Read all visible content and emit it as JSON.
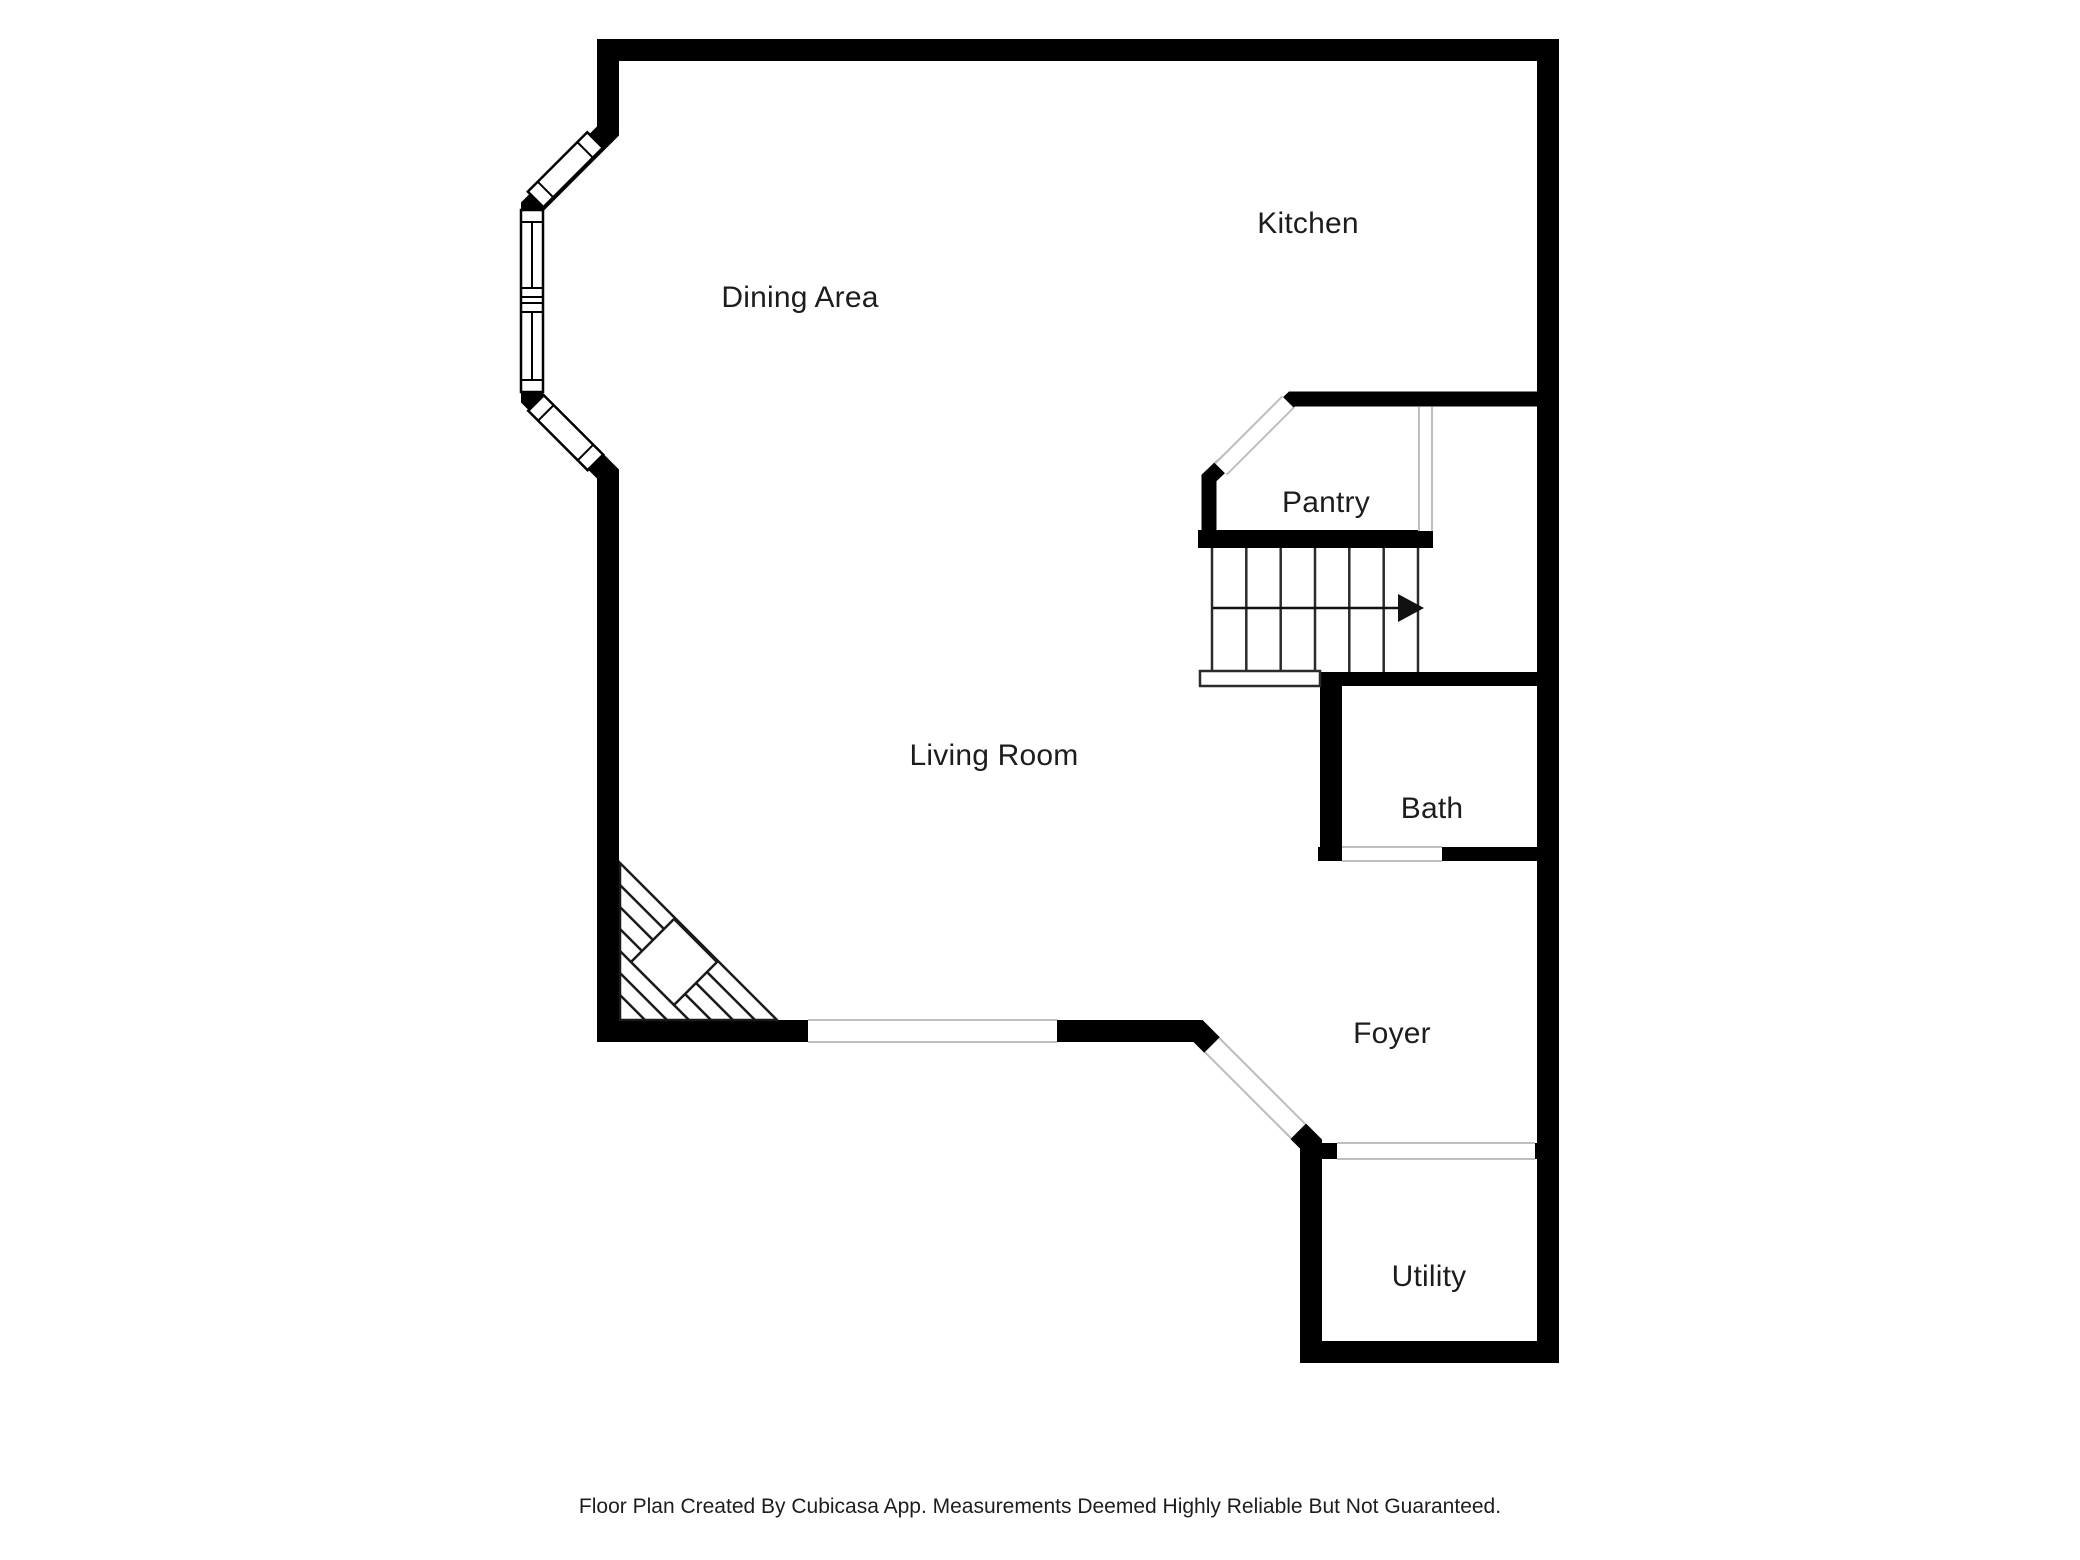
{
  "rooms": {
    "kitchen": {
      "label": "Kitchen"
    },
    "dining": {
      "label": "Dining Area"
    },
    "pantry": {
      "label": "Pantry"
    },
    "living": {
      "label": "Living Room"
    },
    "bath": {
      "label": "Bath"
    },
    "foyer": {
      "label": "Foyer"
    },
    "utility": {
      "label": "Utility"
    }
  },
  "stairs": {
    "treads": 6,
    "direction": "right"
  },
  "features": {
    "windows": 3,
    "door_openings": 6,
    "fireplace": true
  },
  "colors": {
    "wall": "#000000",
    "opening_line": "#bfbfbf",
    "stair_line": "#2b2b2b",
    "text": "#1d1d1d",
    "background": "#ffffff"
  },
  "footer": {
    "disclaimer": "Floor Plan Created By Cubicasa App. Measurements Deemed Highly Reliable But Not Guaranteed."
  }
}
